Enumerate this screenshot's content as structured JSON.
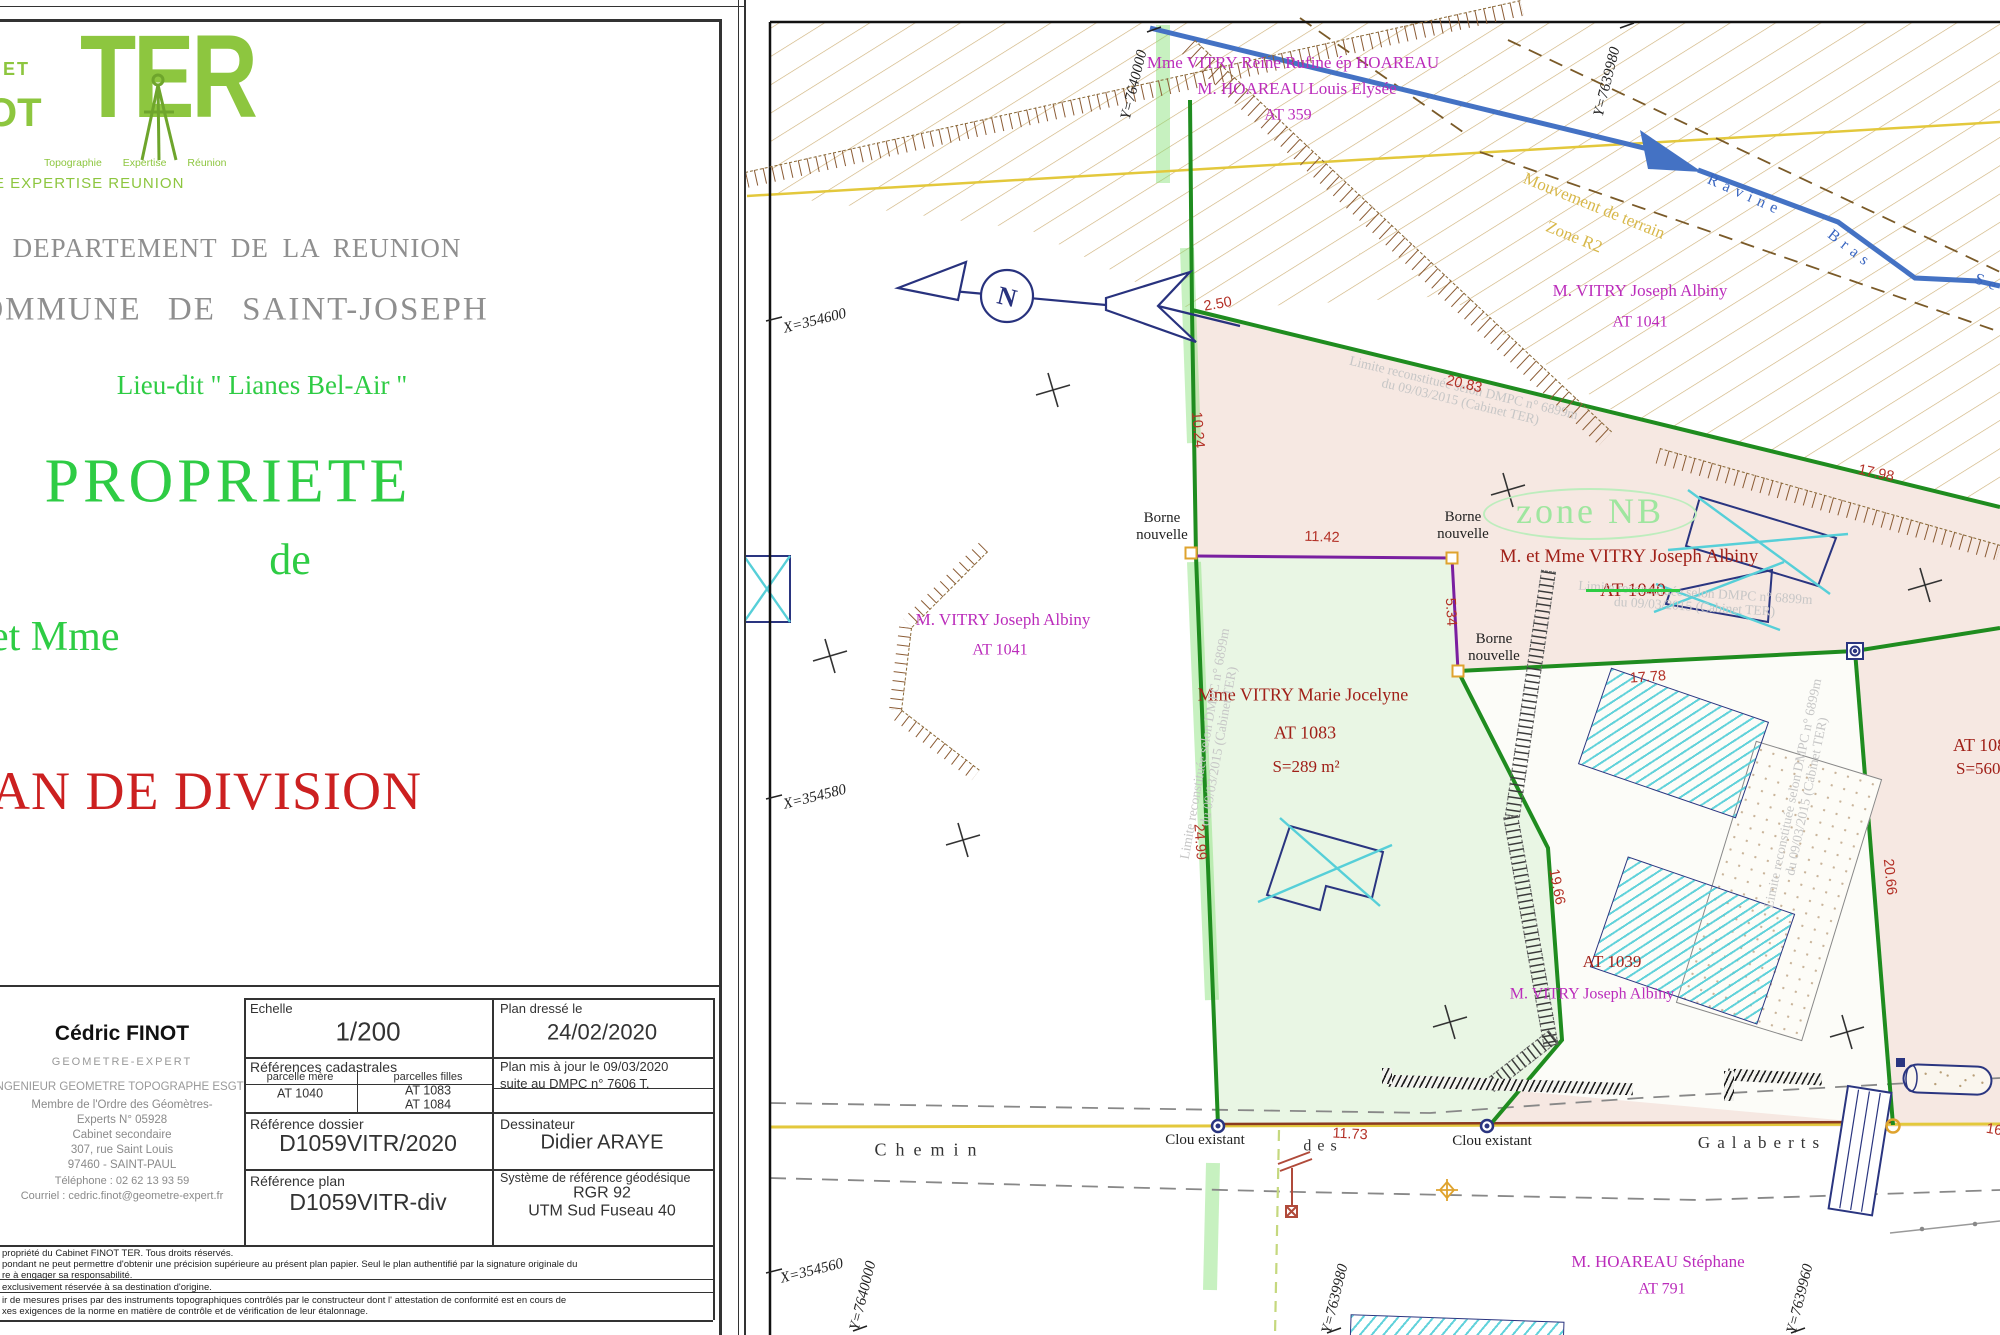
{
  "colors": {
    "logo_green": "#8dc63f",
    "title_green": "#2ecc44",
    "title_gray": "#8f8f8f",
    "title_red": "#cc2020",
    "boundary_green": "#1f8c1f",
    "division_purple": "#7a1fa0",
    "owner_magenta": "#bb2cbb",
    "parcel_red": "#a02018",
    "dimension_red": "#b33026",
    "ravine_blue": "#4472c4",
    "building_navy": "#2a3580",
    "road_yellow": "#e3c83c",
    "hatch_khaki": "#cdb078",
    "parcel_pink_fill": "#f6e8e2",
    "parcel_green_fill": "#e9f6e4",
    "zone_green": "#9fe69f"
  },
  "left_sheet": {
    "logo": {
      "partial_top": "ET",
      "partial_bottom": "OT",
      "ter": "TER",
      "tagline": "Topographie Expertise Réunion",
      "subline": "E EXPERTISE REUNION"
    },
    "department": "DEPARTEMENT DE LA REUNION",
    "commune": "COMMUNE DE SAINT-JOSEPH",
    "lieu_dit": "Lieu-dit  \" Lianes Bel-Air \"",
    "propriete": "PROPRIETE",
    "de": "de",
    "owners_line": "et Mme",
    "plan_title": "PLAN DE DIVISION",
    "surveyor": {
      "name": "Cédric FINOT",
      "title": "GEOMETRE-EXPERT",
      "lines": [
        "INGENIEUR GEOMETRE TOPOGRAPHE ESGT",
        "Membre de l'Ordre des Géomètres-",
        "Experts N° 05928",
        "Cabinet secondaire",
        "307, rue Saint Louis",
        "97460 - SAINT-PAUL",
        "Téléphone : 02 62 13 93 59",
        "Courriel : cedric.finot@geometre-expert.fr"
      ]
    },
    "table": {
      "echelle_label": "Echelle",
      "echelle_value": "1/200",
      "plan_dresse_label": "Plan dressé le",
      "plan_dresse_value": "24/02/2020",
      "ref_cadastrales_label": "Références cadastrales",
      "parcelle_mere_label": "parcelle mère",
      "parcelle_mere_value": "AT 1040",
      "parcelles_filles_label": "parcelles filles",
      "fille1": "AT 1083",
      "fille2": "AT 1084",
      "maj_line1": "Plan mis à jour le 09/03/2020",
      "maj_line2": "suite au DMPC n° 7606 T.",
      "ref_dossier_label": "Référence dossier",
      "ref_dossier_value": "D1059VITR/2020",
      "dessinateur_label": "Dessinateur",
      "dessinateur_value": "Didier ARAYE",
      "ref_plan_label": "Référence plan",
      "ref_plan_value": "D1059VITR-div",
      "geodesie_label": "Système de référence géodésique",
      "geodesie_value1": "RGR 92",
      "geodesie_value2": "UTM Sud Fuseau 40"
    },
    "fine_print": [
      "propriété du Cabinet FINOT TER. Tous droits réservés.",
      "pondant ne peut permettre d'obtenir une précision supérieure au présent plan papier. Seul le plan authentifié par la signature originale du",
      "re à engager sa responsabilité.",
      "exclusivement réservée à sa destination d'origine.",
      "ir de mesures prises par des instruments topographiques contrôlés par le constructeur dont l' attestation de conformité est en cours de",
      "xes exigences de la norme en matière de contrôle et de vérification de leur étalonnage."
    ]
  },
  "map": {
    "grid": {
      "x_labels": [
        "X=354600",
        "X=354580",
        "X=354560"
      ],
      "y_top": [
        "Y=7640000",
        "Y=7639980"
      ],
      "y_bottom": [
        "Y=7640000",
        "Y=7639980",
        "Y=7639960"
      ]
    },
    "north": "N",
    "owner_top": [
      "Mme VITRY Reine Rufine ép HOAREAU",
      "M. HOAREAU Louis Elysée",
      "AT 359"
    ],
    "owner_ne": [
      "M. VITRY Joseph Albiny",
      "AT 1041"
    ],
    "owner_w": [
      "M. VITRY Joseph Albiny",
      "AT 1041"
    ],
    "owner_1040": [
      "M. et Mme VITRY Joseph Albiny",
      "AT 1040"
    ],
    "parcel_1083": [
      "Mme VITRY Marie Jocelyne",
      "AT 1083",
      "S=289 m²"
    ],
    "parcel_1084": [
      "AT 1084",
      "S=560 m²"
    ],
    "parcel_1039": "AT 1039",
    "owner_1039": "M. VITRY Joseph Albiny",
    "owner_s": [
      "M. HOAREAU Stéphane",
      "AT 791"
    ],
    "zone": "zone NB",
    "mouvement": [
      "Mouvement de terrain",
      "Zone R2"
    ],
    "ravine": [
      "Ravine",
      "Bras",
      "Se"
    ],
    "borne_line1": "Borne",
    "borne_line2": "nouvelle",
    "clou": "Clou existant",
    "road": {
      "chemin": "Chemin",
      "des": "des",
      "galaberts": "Galaberts"
    },
    "watermark": [
      "Limite  reconstituée selon DMPC n° 6899m",
      "du 09/03/2015 (Cabinet TER)"
    ],
    "dims": {
      "n2_50": "2.50",
      "w10_24": "10.24",
      "n20_83": "20.83",
      "n17_98": "17.98",
      "p11_42": "11.42",
      "p5_34": "5.34",
      "w24_99": "24.99",
      "d17_78": "17.78",
      "p19_66": "19.66",
      "e20_66": "20.66",
      "r11_73": "11.73",
      "edge": "16"
    }
  }
}
